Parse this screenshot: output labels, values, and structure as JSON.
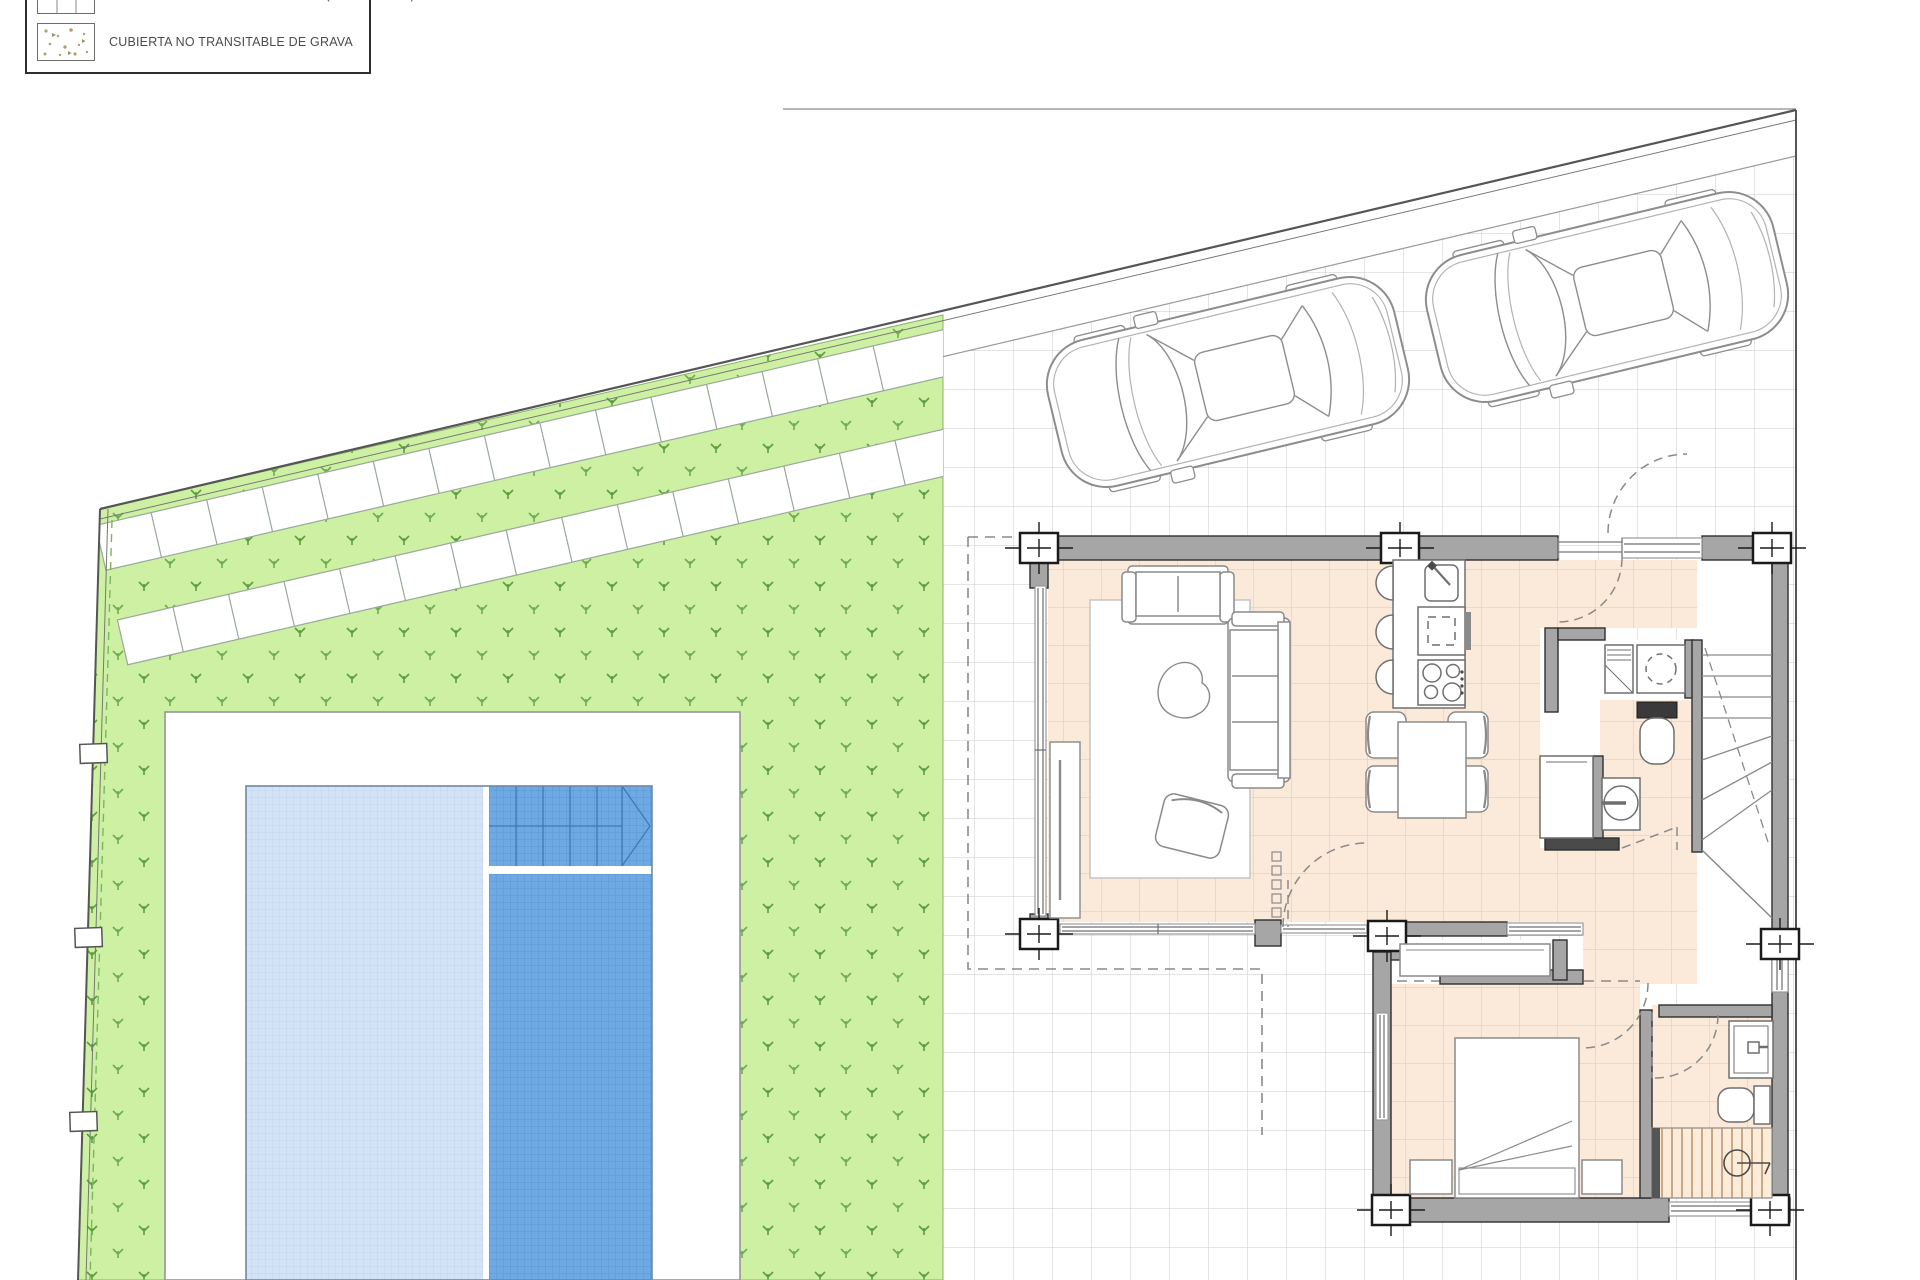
{
  "legend": {
    "items": [
      {
        "swatch": "ceramic-tile-swatch",
        "label": "ENLOSADO CERÁMICO EXTERIOR (Antideslizante)"
      },
      {
        "swatch": "gravel-swatch",
        "label": "CUBIERTA NO TRANSITABLE DE GRAVA"
      }
    ]
  },
  "site": {
    "cars_parked": 2,
    "pool": {
      "sections": 2,
      "separator_band": 1,
      "corner_steps": true
    },
    "walkway_bands": 2,
    "fence_posts": 3
  },
  "colors": {
    "grass_green": "#cdf0a2",
    "plant_green": "#6fae4e",
    "tile_line": "#c9c9c9",
    "wall_gray": "#a6a6a6",
    "wall_outline": "#2f2f2f",
    "floor_peach": "#fbead9",
    "floor_peach_line": "#e6c7a4",
    "pool_light": "#d3e2f6",
    "pool_dark": "#6ea9e4",
    "boundary": "#555555"
  }
}
